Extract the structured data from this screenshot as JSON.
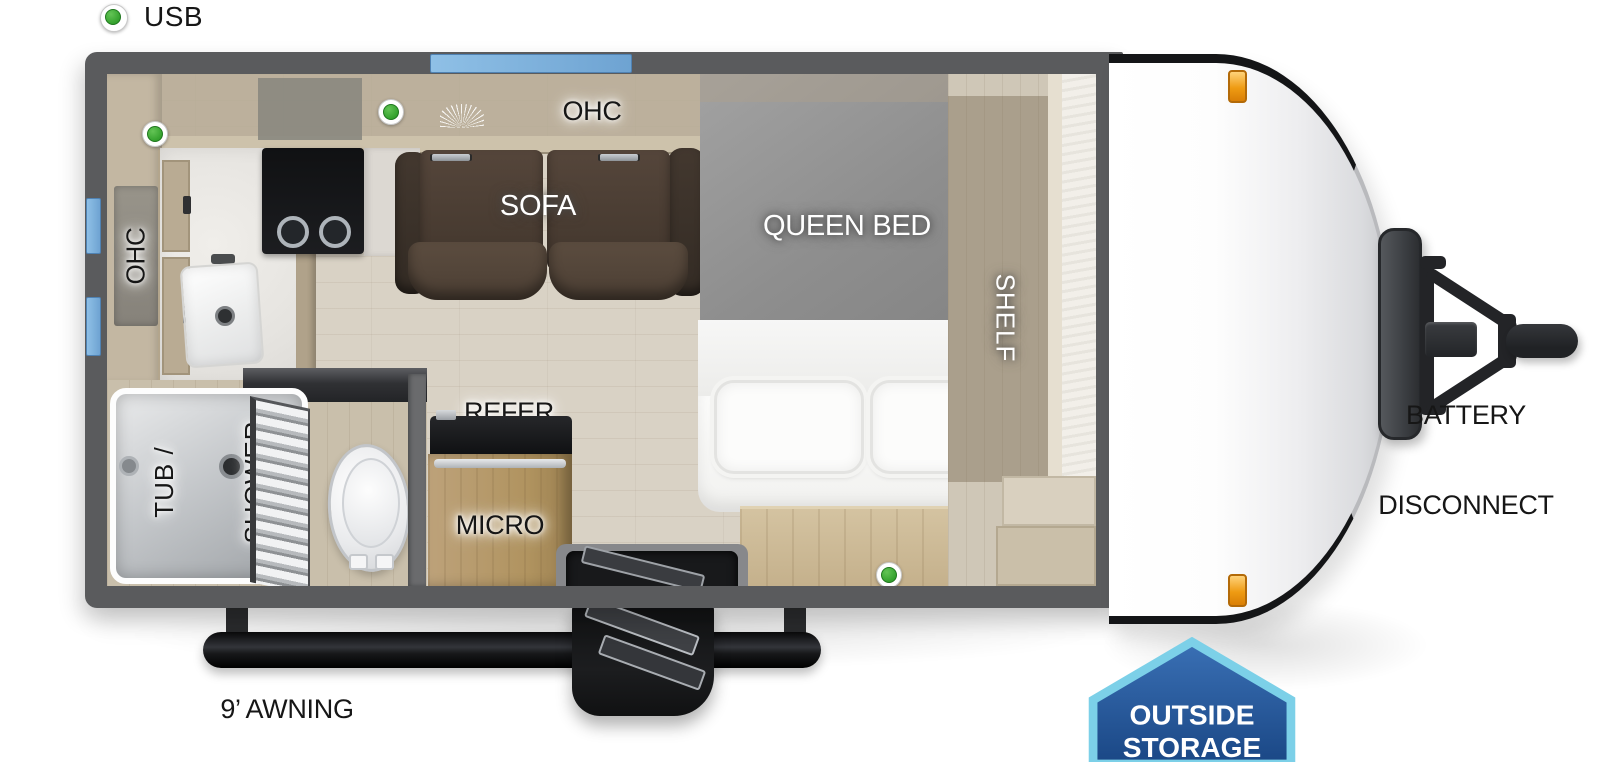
{
  "legend": {
    "usb": "USB"
  },
  "labels": {
    "kitchen_ohc": "OHC",
    "galley_ohc": "OHC",
    "sofa": "SOFA",
    "queen_bed": "QUEEN BED",
    "shelf": "SHELF",
    "tub_shower_1": "TUB /",
    "tub_shower_2": "SHOWER",
    "refer": "REFER",
    "micro": "MICRO"
  },
  "exterior": {
    "awning": "9’ AWNING",
    "battery_1": "BATTERY",
    "battery_2": "DISCONNECT",
    "storage_1": "OUTSIDE",
    "storage_2": "STORAGE"
  },
  "colors": {
    "wall": "#5a5b5d",
    "floor_wood": "#d9d2c5",
    "usb_green": "#35a22e",
    "window_blue": "#7fb2dc",
    "marker_orange": "#f0a030",
    "badge_fill": "#2e63a8",
    "badge_border": "#7cd0e8",
    "sofa_brown": "#4a3d33"
  }
}
